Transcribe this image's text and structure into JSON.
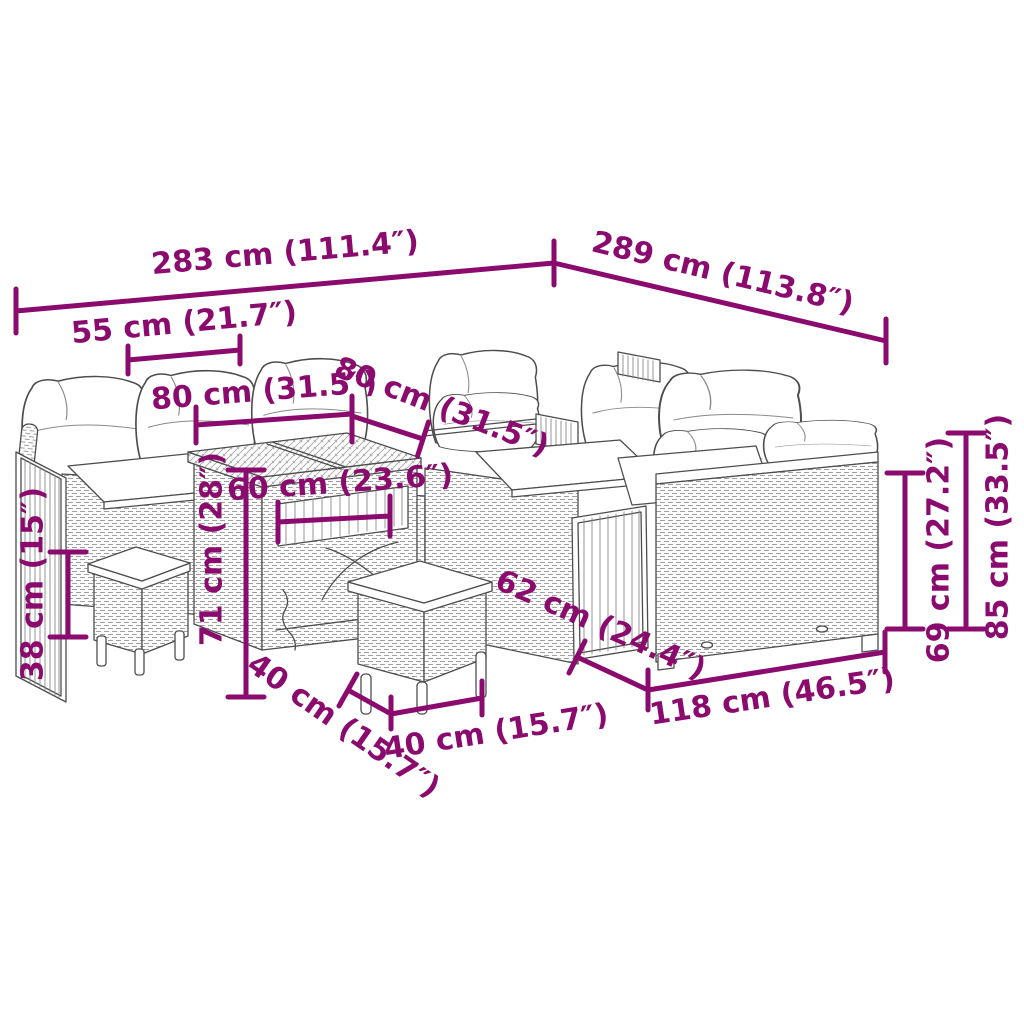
{
  "page": {
    "background": "#ffffff"
  },
  "style": {
    "dimension_color": "#8B0A6E",
    "line_color": "#4d4d4d",
    "cushion_color": "#ffffff"
  },
  "dimensions": {
    "d283": "283 cm (111.4″)",
    "d289": "289 cm (113.8″)",
    "d55": "55 cm (21.7″)",
    "d80a": "80 cm (31.5″)",
    "d80b": "80 cm (31.5″)",
    "d60": "60 cm (23.6″)",
    "d71": "71 cm (28″)",
    "d38": "38 cm (15″)",
    "d62": "62 cm (24.4″)",
    "d118": "118 cm (46.5″)",
    "d69": "69 cm (27.2″)",
    "d85": "85 cm (33.5″)",
    "d40a": "40 cm (15.7″)",
    "d40b": "40 cm (15.7″)"
  }
}
